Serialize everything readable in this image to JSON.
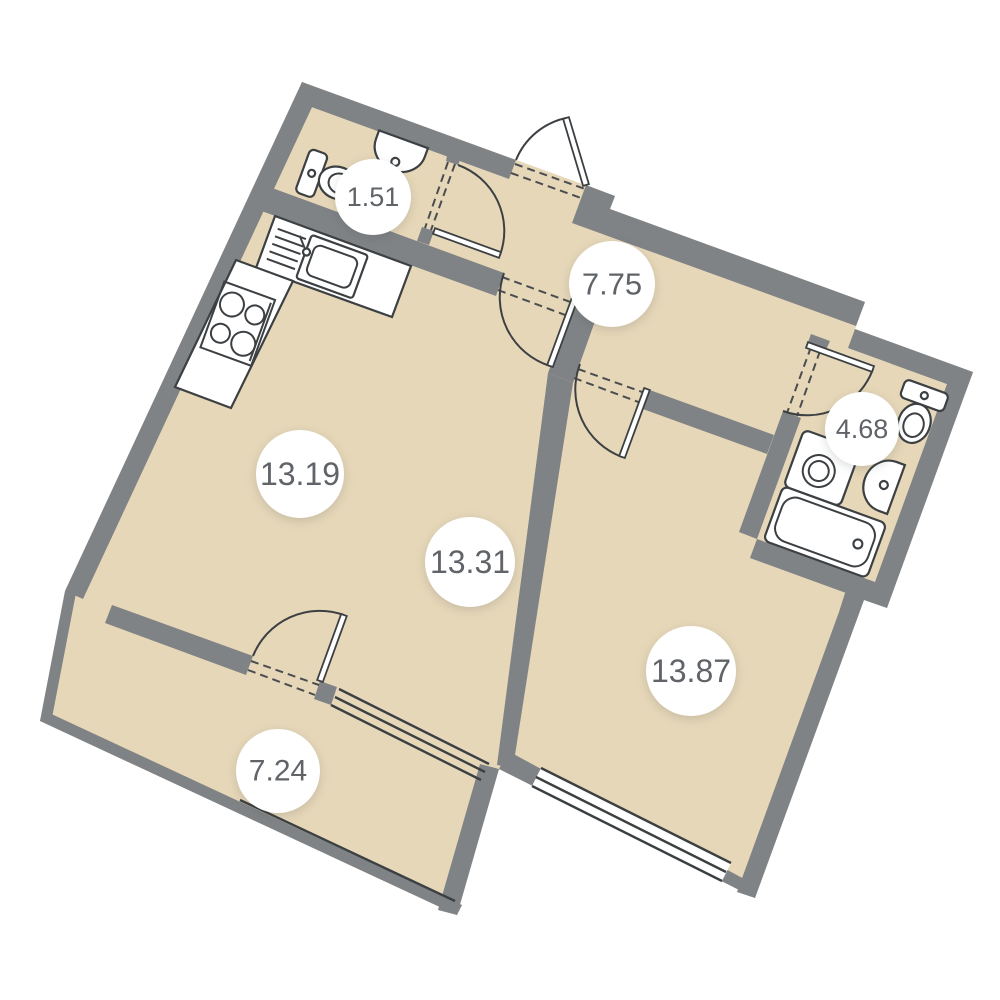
{
  "title": "Apartment floor plan",
  "colors": {
    "background": "#ffffff",
    "floor": "#e6d7b8",
    "wall": "#808386",
    "line": "#3c4043",
    "dash": "#4a4d50",
    "label_text": "#606468",
    "label_bg": "#ffffff"
  },
  "rooms": [
    {
      "name": "wc-small",
      "area": "1.51",
      "x": 373,
      "y": 197,
      "r": 38
    },
    {
      "name": "hallway",
      "area": "7.75",
      "x": 612,
      "y": 284,
      "r": 43
    },
    {
      "name": "bathroom",
      "area": "4.68",
      "x": 862,
      "y": 429,
      "r": 37
    },
    {
      "name": "kitchen",
      "area": "13.19",
      "x": 300,
      "y": 474,
      "r": 44
    },
    {
      "name": "living-room",
      "area": "13.31",
      "x": 470,
      "y": 562,
      "r": 45
    },
    {
      "name": "bedroom",
      "area": "13.87",
      "x": 691,
      "y": 671,
      "r": 45
    },
    {
      "name": "balcony",
      "area": "7.24",
      "x": 278,
      "y": 771,
      "r": 42
    }
  ],
  "fixtures": [
    "toilet",
    "wash-basin",
    "kitchen-sink",
    "stove",
    "washing-machine",
    "toilet",
    "wash-basin",
    "bathtub"
  ]
}
